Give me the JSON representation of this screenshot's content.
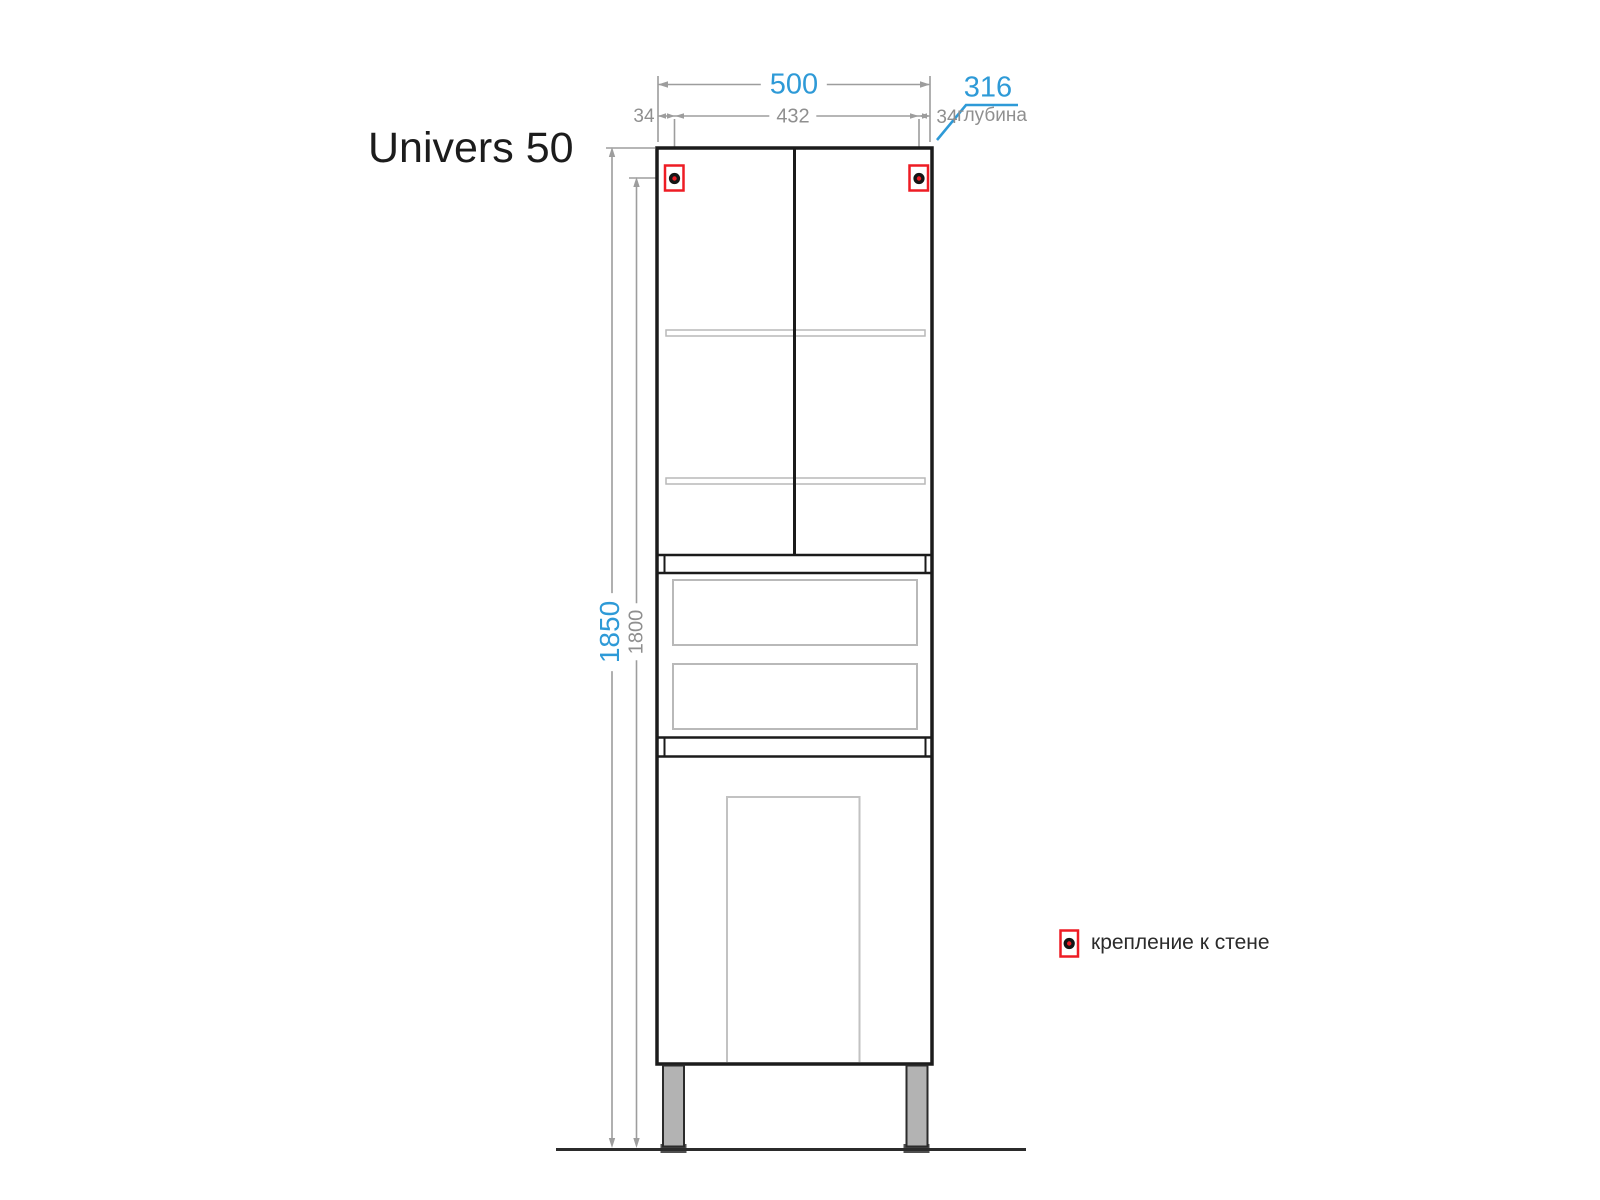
{
  "title": "Univers 50",
  "dimensions": {
    "overall_width": "500",
    "mount_spacing": "432",
    "mount_offset_left": "34",
    "mount_offset_right": "34",
    "depth_value": "316",
    "depth_caption": "глубина",
    "overall_height": "1850",
    "mount_height": "1800"
  },
  "legend": {
    "wall_mount_label": "крепление к стене"
  },
  "colors": {
    "accent_blue": "#2e9ad7",
    "dim_gray": "#9d9d9d",
    "text_gray": "#8f8f8f",
    "outline_black": "#1b1b1b",
    "marker_red": "#ee1c24",
    "panel_gray": "#c2c2c2",
    "leg_fill": "#b3b3b3",
    "leg_foot": "#4f4f4f"
  }
}
